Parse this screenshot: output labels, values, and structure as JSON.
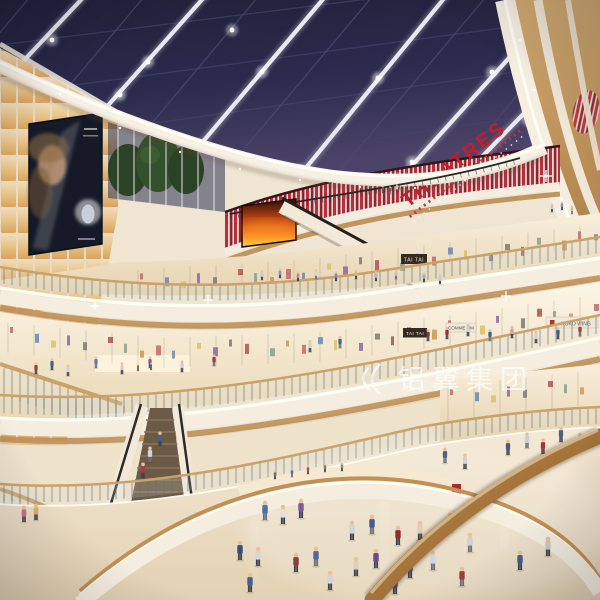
{
  "scene": {
    "title": "Shopping mall atrium interior rendering",
    "signs": {
      "theatres": "THEATRES",
      "tai_tai_upper": "TAI TAI",
      "tai_tai_lower": "TAI TAI",
      "koko_wing": "KOKO WING",
      "comme": "COMME HM"
    },
    "watermark": {
      "text": "铝翼集团"
    },
    "billboard_ad": "woman-portrait-perfume-ad",
    "colors": {
      "sky_navy": "#26263f",
      "beam_white": "#f0f1fa",
      "red_slat": "#b5303a",
      "theatres_red": "#c41e2a",
      "cream": "#f5eee0",
      "wood": "#c59a5f",
      "glow_warm": "#f9e2b0",
      "floor": "#ece0c9",
      "rail_wood": "#a06a33"
    },
    "shops": {
      "merch_colors": [
        "#c06a6a",
        "#6a88b0",
        "#d8c26a",
        "#8a6aa0",
        "#7a7a72",
        "#b05050",
        "#88a08a",
        "#c89a58"
      ],
      "bands": [
        {
          "pts": [
            [
              130,
              268
            ],
            [
              300,
              258
            ],
            [
              450,
              240
            ],
            [
              600,
              222
            ]
          ],
          "h": 26
        },
        {
          "pts": [
            [
              0,
              320
            ],
            [
              160,
              336
            ],
            [
              320,
              330
            ],
            [
              460,
              312
            ],
            [
              600,
              292
            ]
          ],
          "h": 34
        },
        {
          "pts": [
            [
              440,
              384
            ],
            [
              600,
              368
            ]
          ],
          "h": 40
        }
      ]
    },
    "people": [
      [
        383,
        193,
        0.4,
        "#5a5a6a"
      ],
      [
        390,
        194,
        0.4,
        "#8a4a4a"
      ],
      [
        397,
        192,
        0.4,
        "#c8c8d0"
      ],
      [
        552,
        212,
        0.45,
        "#c2c2ca"
      ],
      [
        562,
        210,
        0.45,
        "#8292b2"
      ],
      [
        572,
        214,
        0.45,
        "#c8b8a2"
      ],
      [
        262,
        280,
        0.5,
        "#c2cad2"
      ],
      [
        280,
        278,
        0.5,
        "#8b9cba"
      ],
      [
        298,
        281,
        0.5,
        "#c78396"
      ],
      [
        316,
        279,
        0.5,
        "#d6d6d6"
      ],
      [
        336,
        281,
        0.5,
        "#7e8eb2"
      ],
      [
        356,
        279,
        0.5,
        "#cabd96"
      ],
      [
        376,
        281,
        0.5,
        "#a3b2c8"
      ],
      [
        396,
        279,
        0.5,
        "#d2c2aa"
      ],
      [
        424,
        282,
        0.5,
        "#96a6c0"
      ],
      [
        440,
        284,
        0.5,
        "#c0ccd8"
      ],
      [
        310,
        352,
        0.62,
        "#ccd4da"
      ],
      [
        340,
        348,
        0.62,
        "#47628e"
      ],
      [
        428,
        341,
        0.62,
        "#6d3d3d"
      ],
      [
        447,
        339,
        0.62,
        "#90304e"
      ],
      [
        468,
        336,
        0.62,
        "#d2d2d2"
      ],
      [
        490,
        341,
        0.62,
        "#40608e"
      ],
      [
        512,
        338,
        0.62,
        "#c8a2b2"
      ],
      [
        536,
        343,
        0.62,
        "#d8cfc0"
      ],
      [
        558,
        339,
        0.62,
        "#48628e"
      ],
      [
        580,
        336,
        0.62,
        "#9c4242"
      ],
      [
        36,
        374,
        0.6,
        "#a23a3a"
      ],
      [
        52,
        370,
        0.6,
        "#40608e"
      ],
      [
        68,
        376,
        0.6,
        "#d2d2d2"
      ],
      [
        96,
        368,
        0.6,
        "#5e7eb0"
      ],
      [
        122,
        374,
        0.6,
        "#d8cfc0"
      ],
      [
        150,
        368,
        0.6,
        "#7c5c9c"
      ],
      [
        182,
        372,
        0.6,
        "#c8ced4"
      ],
      [
        214,
        366,
        0.6,
        "#9c3838"
      ],
      [
        138,
        371,
        0.38,
        "#8a6a4a"
      ],
      [
        151,
        370,
        0.38,
        "#5a6a8a"
      ],
      [
        508,
        455,
        0.8,
        "#5c4c8c"
      ],
      [
        527,
        448,
        0.8,
        "#c9cfd6"
      ],
      [
        543,
        454,
        0.8,
        "#9c3838"
      ],
      [
        561,
        442,
        0.8,
        "#48628e"
      ],
      [
        580,
        448,
        0.8,
        "#d9d2c4"
      ],
      [
        445,
        463,
        0.8,
        "#48628e"
      ],
      [
        465,
        469,
        0.8,
        "#d2d2d2"
      ],
      [
        24,
        522,
        0.85,
        "#c8708e"
      ],
      [
        36,
        520,
        0.85,
        "#d8b06a"
      ],
      [
        150,
        462,
        0.8,
        "#cfd6dc"
      ],
      [
        160,
        446,
        0.75,
        "#44608e"
      ],
      [
        143,
        478,
        0.8,
        "#9c4040"
      ],
      [
        275,
        479,
        0.45,
        "#8a6a5a"
      ],
      [
        292,
        477,
        0.45,
        "#5a6a8a"
      ],
      [
        308,
        474,
        0.45,
        "#9a5a5a"
      ],
      [
        325,
        472,
        0.45,
        "#6a7a9a"
      ],
      [
        342,
        471,
        0.45,
        "#8a8a7a"
      ],
      [
        265,
        520,
        1,
        "#4a6fae"
      ],
      [
        283,
        524,
        1,
        "#e0e0e0"
      ],
      [
        301,
        518,
        1,
        "#7a5a9a"
      ],
      [
        352,
        540,
        1,
        "#cdd5d9"
      ],
      [
        372,
        534,
        1,
        "#3f5d8e"
      ],
      [
        398,
        545,
        1,
        "#8e2f2f"
      ],
      [
        420,
        540,
        1,
        "#d8cfc0"
      ],
      [
        450,
        532,
        1,
        "#476b9e"
      ],
      [
        470,
        552,
        1,
        "#d0d0d0"
      ],
      [
        240,
        560,
        1,
        "#334f7d"
      ],
      [
        258,
        566,
        1,
        "#d6d6d6"
      ],
      [
        296,
        572,
        1,
        "#8e3a3a"
      ],
      [
        316,
        566,
        1,
        "#4c6b9a"
      ],
      [
        356,
        576,
        1,
        "#d8d0c2"
      ],
      [
        376,
        568,
        1,
        "#6a4a8a"
      ],
      [
        410,
        578,
        1,
        "#3e5c88"
      ],
      [
        433,
        570,
        1,
        "#cfd6dc"
      ],
      [
        250,
        592,
        1,
        "#44608e"
      ],
      [
        330,
        590,
        1,
        "#d4d4d4"
      ],
      [
        395,
        594,
        1,
        "#55427e"
      ],
      [
        462,
        586,
        1,
        "#9c4040"
      ],
      [
        520,
        570,
        1,
        "#46608c"
      ],
      [
        548,
        556,
        1,
        "#d0c8ba"
      ]
    ]
  }
}
